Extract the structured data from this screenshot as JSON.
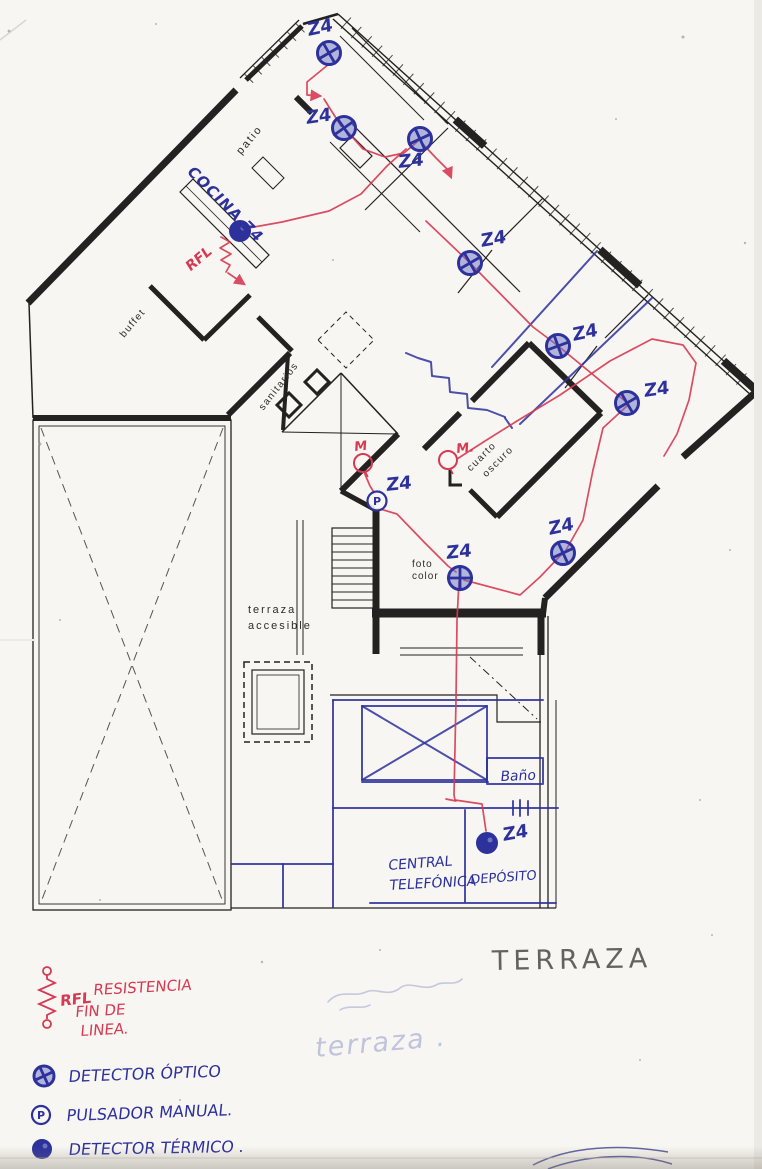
{
  "document_type": "scanned fire-alarm wiring floor plan",
  "colors": {
    "paper": "#f8f6f2",
    "print_black": "#232220",
    "blue_ink": "#2d319c",
    "blue_ink_soft": "#6b73c4",
    "red_ink": "#d63a52",
    "pencil": "#4a4a45",
    "faint_blue": "#929ac9"
  },
  "printed_labels": {
    "patio": "patio",
    "buffet": "buffet",
    "sanitarios": "sanitarios",
    "cuarto_oscuro": [
      "cuarto",
      "oscuro"
    ],
    "foto_color": [
      "foto",
      "color"
    ],
    "terraza_accesible": [
      "terraza",
      "accesible"
    ]
  },
  "handwritten": {
    "cocina_zone": "COCINA Z4",
    "rfl_mark": "RFL",
    "bano": "Baño",
    "central_telefonica": [
      "CENTRAL",
      "TELEFÓNICA"
    ],
    "deposito": "DEPÓSITO",
    "terraza_pencil": "TERRAZA",
    "terraza_faint": "terraza ."
  },
  "zone_label_text": "Z4",
  "devices": [
    {
      "id": "optical-detector-entry-top",
      "type": "optical",
      "x": 329,
      "y": 53,
      "label": "Z4",
      "lx": 308,
      "ly": 36,
      "lrot": -12,
      "cr": 15
    },
    {
      "id": "optical-detector-patio",
      "type": "optical",
      "x": 344,
      "y": 128,
      "label": "Z4",
      "lx": 306,
      "ly": 124,
      "lrot": -8,
      "cr": 10
    },
    {
      "id": "optical-detector-hall",
      "type": "optical",
      "x": 420,
      "y": 139,
      "label": "Z4",
      "lx": 398,
      "ly": 168,
      "lrot": -6,
      "cr": 20
    },
    {
      "id": "optical-detector-room-1",
      "type": "optical",
      "x": 470,
      "y": 263,
      "label": "Z4",
      "lx": 481,
      "ly": 247,
      "lrot": -10,
      "cr": 15
    },
    {
      "id": "optical-detector-room-2",
      "type": "optical",
      "x": 558,
      "y": 346,
      "label": "Z4",
      "lx": 573,
      "ly": 341,
      "lrot": -12,
      "cr": 25
    },
    {
      "id": "optical-detector-room-3",
      "type": "optical",
      "x": 627,
      "y": 403,
      "label": "Z4",
      "lx": 644,
      "ly": 397,
      "lrot": -8,
      "cr": 15
    },
    {
      "id": "thermal-detector-cocina",
      "type": "thermal",
      "x": 240,
      "y": 231,
      "label": "",
      "lx": 0,
      "ly": 0,
      "lrot": 0
    },
    {
      "id": "pulsador-blue-wing",
      "type": "pulsador",
      "x": 377,
      "y": 501,
      "label": "Z4",
      "lx": 386,
      "ly": 491,
      "lrot": -6
    },
    {
      "id": "optical-detector-foto-color",
      "type": "optical",
      "x": 460,
      "y": 578,
      "label": "Z4",
      "lx": 446,
      "ly": 559,
      "lrot": -6,
      "cr": 45
    },
    {
      "id": "optical-detector-wing",
      "type": "optical",
      "x": 563,
      "y": 553,
      "label": "Z4",
      "lx": 549,
      "ly": 535,
      "lrot": -12,
      "cr": 20
    },
    {
      "id": "thermal-detector-deposito",
      "type": "thermal",
      "x": 487,
      "y": 843,
      "label": "Z4",
      "lx": 503,
      "ly": 841,
      "lrot": -10
    }
  ],
  "red_circles": [
    {
      "id": "pulsador-red-m1",
      "x": 363,
      "y": 463,
      "label": "M",
      "lx": 354,
      "ly": 451
    },
    {
      "id": "pulsador-red-m2",
      "x": 448,
      "y": 460,
      "label": "M.",
      "lx": 456,
      "ly": 453
    }
  ],
  "red_wires": [
    {
      "points": "329,64 307,82 307,95 320,96",
      "arrow": true
    },
    {
      "points": "324,99 341,126"
    },
    {
      "points": "346,130 363,149 385,157 404,153 417,142"
    },
    {
      "points": "243,229 282,222 329,211 361,194 387,166 406,149"
    },
    {
      "points": "421,142 436,158 448,170 451,177",
      "arrow": true
    },
    {
      "points": "426,221 469,262 533,327 557,345 625,401"
    },
    {
      "points": "628,405 603,428 593,470 583,520 566,550"
    },
    {
      "points": "561,555 540,577 520,595 464,580"
    },
    {
      "points": "459,581 457,620 456,700 454,795 455,800 482,804 486,831"
    },
    {
      "points": "446,799 456,801"
    },
    {
      "points": "364,472 370,486 375,494"
    },
    {
      "points": "380,509 397,514 424,542 448,566 456,572"
    },
    {
      "points": "457,459 485,441 517,421 560,395 610,361 652,339 683,345 696,363 689,400 677,434 664,456"
    },
    {
      "d": "M221,237 l9,5 -10,6 11,6 -10,6 9,5 -4,7"
    },
    {
      "points": "228,273 244,284",
      "arrow": true
    }
  ],
  "blue_lines": [
    {
      "points": "597,251 492,367"
    },
    {
      "points": "652,298 520,424"
    },
    {
      "points": "406,353 418,358 431,362 432,376 449,378 450,392 467,394 468,408 487,410 505,417"
    },
    {
      "points": "505,418 512,428"
    },
    {
      "points": "333,700 543,700"
    },
    {
      "points": "362,706 487,706 487,780 362,780 362,706"
    },
    {
      "points": "362,706 487,780"
    },
    {
      "points": "487,706 362,780"
    },
    {
      "points": "362,782 488,782"
    },
    {
      "points": "487,758 543,758 543,784 487,784 487,758"
    },
    {
      "points": "333,808 558,808"
    },
    {
      "points": "513,801 513,815"
    },
    {
      "points": "520,800 520,816"
    },
    {
      "points": "528,801 528,815"
    },
    {
      "points": "465,810 465,902"
    },
    {
      "points": "370,903 556,903"
    },
    {
      "points": "333,700 333,907"
    },
    {
      "points": "283,864 283,907"
    },
    {
      "points": "232,864 333,864"
    }
  ],
  "scribbles": [
    {
      "d": "M328,1002 c12,-14 26,-4 38,-10 c10,-5 22,6 34,-4 c10,-8 24,4 36,-3 c8,-5 18,2 26,-6"
    },
    {
      "d": "M340,1010 c10,-6 22,0 30,-5"
    }
  ],
  "signature_strokes": [
    {
      "d": "M533,1165 C570,1146 620,1144 668,1152"
    },
    {
      "d": "M548,1169 C585,1155 635,1152 672,1164"
    }
  ],
  "legend": {
    "rfl_abbr": "RFL",
    "rfl_lines": [
      "RESISTENCIA",
      "FIN DE",
      "LINEA."
    ],
    "optical": "DETECTOR ÓPTICO",
    "pulsador": "PULSADOR MANUAL.",
    "thermal": "DETECTOR TÉRMICO ."
  }
}
